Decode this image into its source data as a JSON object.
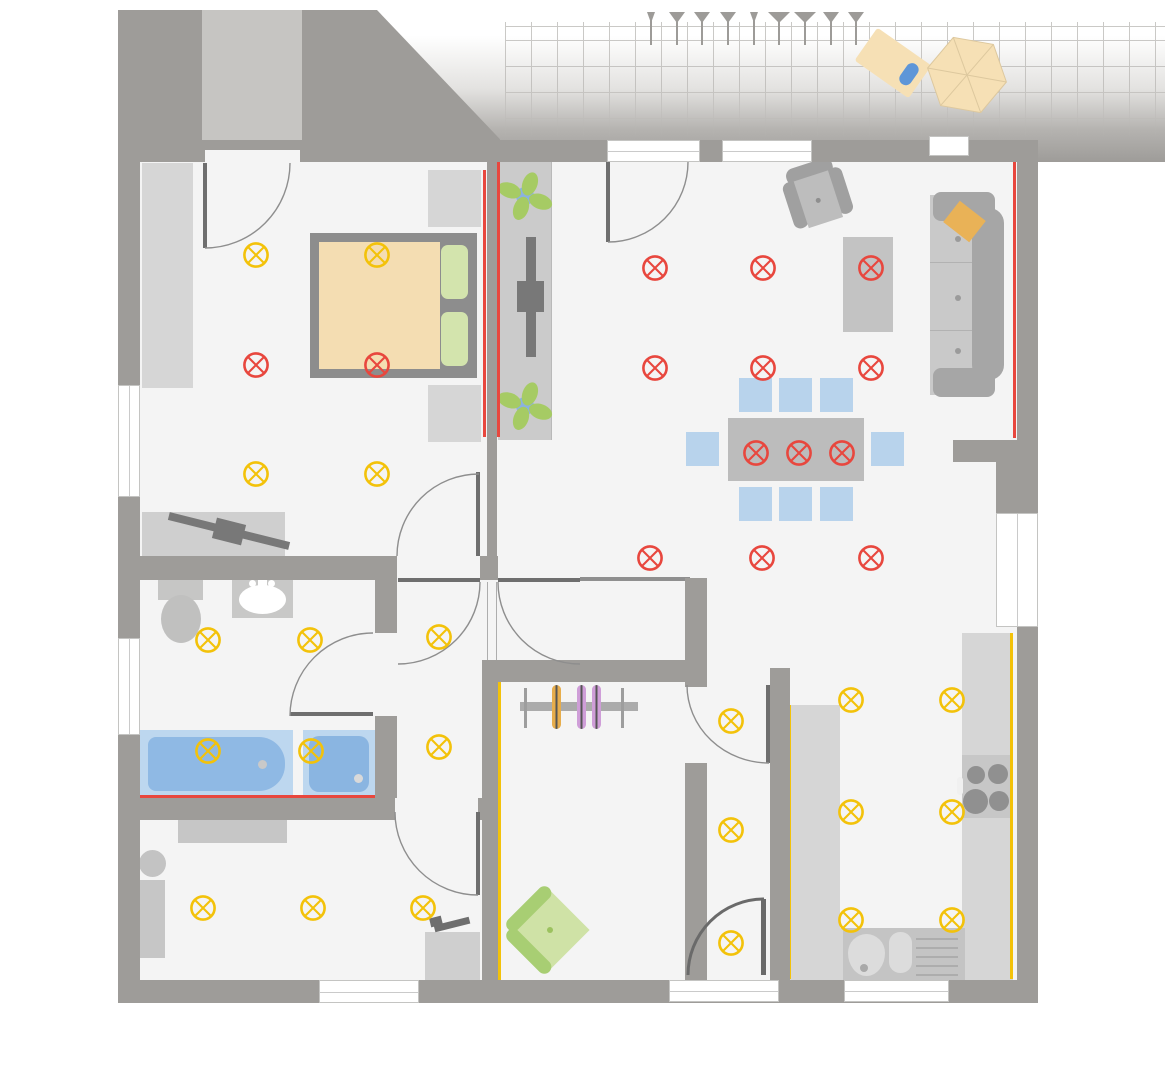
{
  "app": {
    "name": "apartment-floor-plan",
    "view": "ceiling-lighting-plan",
    "visible_text": "none"
  },
  "colors": {
    "wall": "#9e9c99",
    "floor": "#f4f4f4",
    "outside": "#ffffff",
    "vestibule": "#c6c5c2",
    "light_yellow": "#f3c20a",
    "light_red": "#e8473e",
    "fur1": "#d6d6d6",
    "fur2": "#c3c3c3",
    "fur3": "#a6a6a6",
    "dark": "#6e6e6e",
    "chairblue": "#b8d3ec",
    "tublight": "#bdd7ef",
    "tubblue": "#8fb9e4",
    "tan": "#f4ddb2",
    "greenlight": "#d3e4ad",
    "green": "#a8ce73",
    "greenseat": "#cfe2a6",
    "plant": "#a6cb64",
    "plantblue": "#8bb2de",
    "beige": "#f6e0b5",
    "orange": "#e9b257",
    "hanger_orange": "#e7ad4c",
    "hanger_purple": "#cf9ed8",
    "grid_line": "#b9b7b4",
    "door_arc": "#8e8e8e"
  },
  "lights": {
    "symbol": "circle-with-x (ceiling lamp outlet)",
    "yellow": [
      [
        256,
        255
      ],
      [
        377,
        255
      ],
      [
        256,
        474
      ],
      [
        377,
        474
      ],
      [
        208,
        640
      ],
      [
        310,
        640
      ],
      [
        208,
        751
      ],
      [
        311,
        751
      ],
      [
        439,
        637
      ],
      [
        439,
        747
      ],
      [
        203,
        908
      ],
      [
        313,
        908
      ],
      [
        423,
        908
      ],
      [
        731,
        721
      ],
      [
        731,
        830
      ],
      [
        731,
        943
      ],
      [
        851,
        700
      ],
      [
        952,
        700
      ],
      [
        851,
        812
      ],
      [
        952,
        812
      ],
      [
        851,
        920
      ],
      [
        952,
        920
      ]
    ],
    "red": [
      [
        256,
        365
      ],
      [
        377,
        365
      ],
      [
        655,
        268
      ],
      [
        763,
        268
      ],
      [
        871,
        268
      ],
      [
        655,
        368
      ],
      [
        763,
        368
      ],
      [
        871,
        368
      ],
      [
        756,
        453
      ],
      [
        799,
        453
      ],
      [
        842,
        453
      ],
      [
        650,
        558
      ],
      [
        762,
        558
      ],
      [
        871,
        558
      ]
    ],
    "yellow_count": 22,
    "red_count": 14
  },
  "strips": {
    "red": [
      [
        483,
        170,
        3,
        267
      ],
      [
        497,
        162,
        3,
        275
      ],
      [
        1013,
        162,
        3,
        276
      ],
      [
        232,
        574,
        61,
        3
      ],
      [
        140,
        795,
        235,
        3
      ]
    ],
    "yellow": [
      [
        498,
        682,
        3,
        321
      ],
      [
        788,
        705,
        3,
        274
      ],
      [
        1010,
        633,
        3,
        346
      ]
    ]
  },
  "terrace": {
    "ticks": [
      {
        "x": 651,
        "s": "s"
      },
      {
        "x": 677,
        "s": "m"
      },
      {
        "x": 702,
        "s": "m"
      },
      {
        "x": 728,
        "s": "m"
      },
      {
        "x": 754,
        "s": "s"
      },
      {
        "x": 779,
        "s": "l"
      },
      {
        "x": 805,
        "s": "l"
      },
      {
        "x": 831,
        "s": "m"
      },
      {
        "x": 856,
        "s": "m"
      }
    ],
    "grid": {
      "v_spacing": 26,
      "h_lines_y": [
        40,
        66,
        92
      ]
    },
    "objects": [
      "sun-lounger-with-pillow",
      "parasol-hexagon"
    ]
  },
  "rooms": [
    {
      "name": "bedroom",
      "furniture": [
        "wardrobe",
        "double-bed",
        "nightstand",
        "nightstand",
        "tv-board",
        "tv"
      ]
    },
    {
      "name": "living-dining-room",
      "furniture": [
        "armchair",
        "sofa",
        "sofa-pillow",
        "sideboard",
        "dining-table",
        "chairs-x8",
        "tv-lowboard",
        "tv",
        "plant",
        "plant"
      ]
    },
    {
      "name": "bathroom",
      "furniture": [
        "toilet",
        "sink",
        "bathtub",
        "shower"
      ]
    },
    {
      "name": "study",
      "furniture": [
        "sideboard",
        "round-chair",
        "shelf",
        "desk",
        "desk-lamp"
      ]
    },
    {
      "name": "dressing-room",
      "furniture": [
        "clothes-rail",
        "hangers-x3",
        "armchair-green"
      ]
    },
    {
      "name": "hallway",
      "furniture": []
    },
    {
      "name": "kitchen",
      "furniture": [
        "counter-left",
        "counter-right",
        "stove-4-burners",
        "sink-with-drainer"
      ]
    },
    {
      "name": "terrace",
      "furniture": [
        "sun-lounger",
        "parasol"
      ]
    }
  ]
}
